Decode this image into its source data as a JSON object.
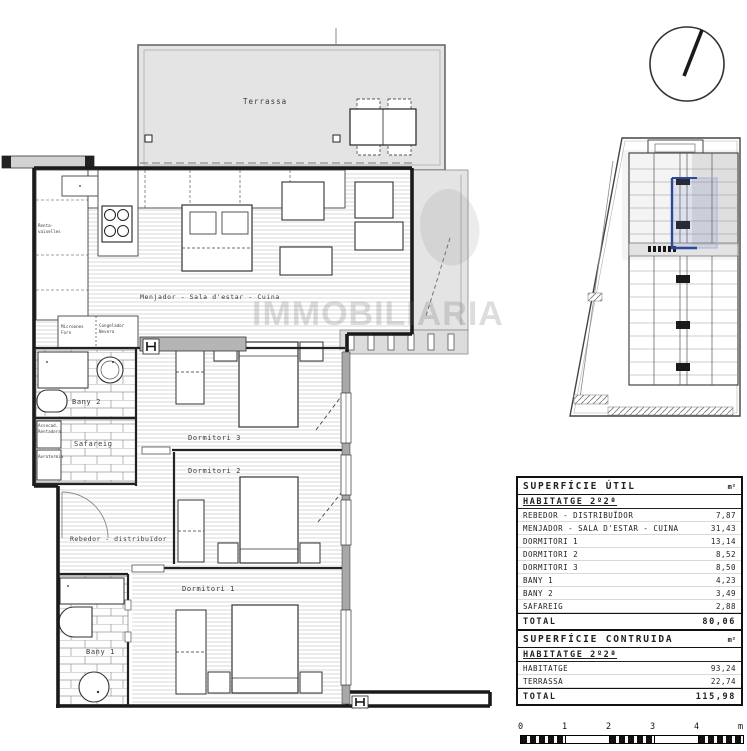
{
  "plan": {
    "watermark": "IMMOBILIARIA",
    "rooms": {
      "terrassa": "Terrassa",
      "living": "Menjador - Sala d'estar - Cuina",
      "dormitori1": "Dormitori 1",
      "dormitori2": "Dormitori 2",
      "dormitori3": "Dormitori 3",
      "bany1": "Bany 1",
      "bany2": "Bany 2",
      "safareig": "Safareig",
      "rebedor": "Rebedor - distribuïdor"
    },
    "appliances": {
      "dishwasher1": "Renta-",
      "dishwasher2": "vaixelles",
      "micro1": "Microones",
      "micro2": "Forn",
      "fridge1": "Congelador",
      "fridge2": "Nevera",
      "washer1": "Assecad.",
      "washer2": "Rentadora",
      "aero": "Aerotermia"
    }
  },
  "tables": {
    "util": {
      "title": "SUPERFÍCIE ÚTIL",
      "unit": "m²",
      "subtitle": "HABITATGE 2º2ª",
      "rows": [
        {
          "label": "REBEDOR - DISTRIBUÏDOR",
          "value": "7,87"
        },
        {
          "label": "MENJADOR - SALA D'ESTAR - CUINA",
          "value": "31,43"
        },
        {
          "label": "DORMITORI 1",
          "value": "13,14"
        },
        {
          "label": "DORMITORI 2",
          "value": "8,52"
        },
        {
          "label": "DORMITORI 3",
          "value": "8,50"
        },
        {
          "label": "BANY 1",
          "value": "4,23"
        },
        {
          "label": "BANY 2",
          "value": "3,49"
        },
        {
          "label": "SAFAREIG",
          "value": "2,88"
        }
      ],
      "total_label": "TOTAL",
      "total_value": "80,06"
    },
    "construida": {
      "title": "SUPERFÍCIE CONTRUIDA",
      "unit": "m²",
      "subtitle": "HABITATGE 2º2ª",
      "rows": [
        {
          "label": "HABITATGE",
          "value": "93,24"
        },
        {
          "label": "TERRASSA",
          "value": "22,74"
        }
      ],
      "total_label": "TOTAL",
      "total_value": "115,98"
    }
  },
  "scalebar": {
    "labels": [
      "0",
      "1",
      "2",
      "3",
      "4",
      "m"
    ]
  },
  "colors": {
    "terrace_fill": "#e4e4e4",
    "wall": "#1a1a1a",
    "highlight_blue": "#2b4a9b"
  }
}
